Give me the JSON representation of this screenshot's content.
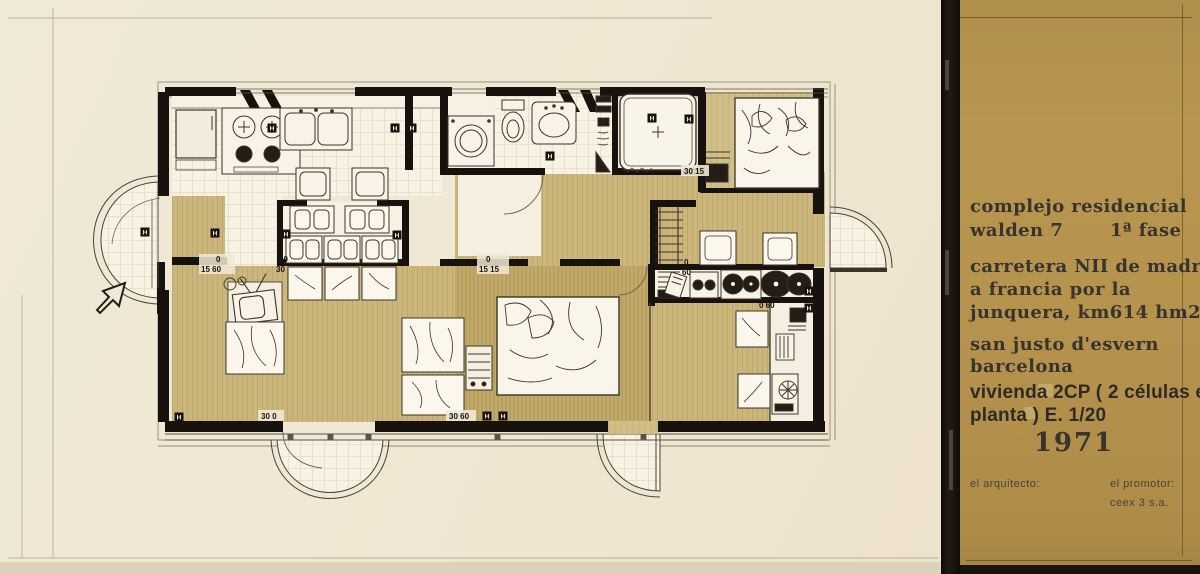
{
  "document": {
    "kind": "architectural floor plan drawing"
  },
  "panel": {
    "bg": "#b5934e",
    "title_line1": "complejo residencial",
    "title_line2": "walden 7",
    "phase": "1ª fase",
    "address_line1": "carretera NII de madrid",
    "address_line2": "a francia por la",
    "address_line3": "junquera, km614  hm2.",
    "city_line1": "san justo d'esvern",
    "city_line2": "barcelona",
    "drawing_line1": "vivienda   2CP ( 2 células en",
    "drawing_line2": "planta  ) E. 1/20",
    "year": "1971",
    "architect_label": "el  arquitecto:",
    "promoter_label": "el  promotor:",
    "promoter_name": "ceex 3 s.a."
  },
  "plan": {
    "h_letter": "H",
    "labels": [
      {
        "text": "0"
      },
      {
        "text": "15 60"
      },
      {
        "text": "60"
      },
      {
        "text": "30"
      },
      {
        "text": "0"
      },
      {
        "text": "15 15"
      },
      {
        "text": "0"
      },
      {
        "text": "60"
      },
      {
        "text": "30 15"
      },
      {
        "text": "0 60"
      },
      {
        "text": "30 60"
      },
      {
        "text": "30 0"
      }
    ],
    "colors": {
      "paper": "#efe6d3",
      "tan_floor": "#cbb67b",
      "tan_floor_dark": "#c1a967",
      "wall_ink": "#17120d",
      "sketch_ink": "#3c342a",
      "panel_brown": "#b5934e"
    }
  }
}
